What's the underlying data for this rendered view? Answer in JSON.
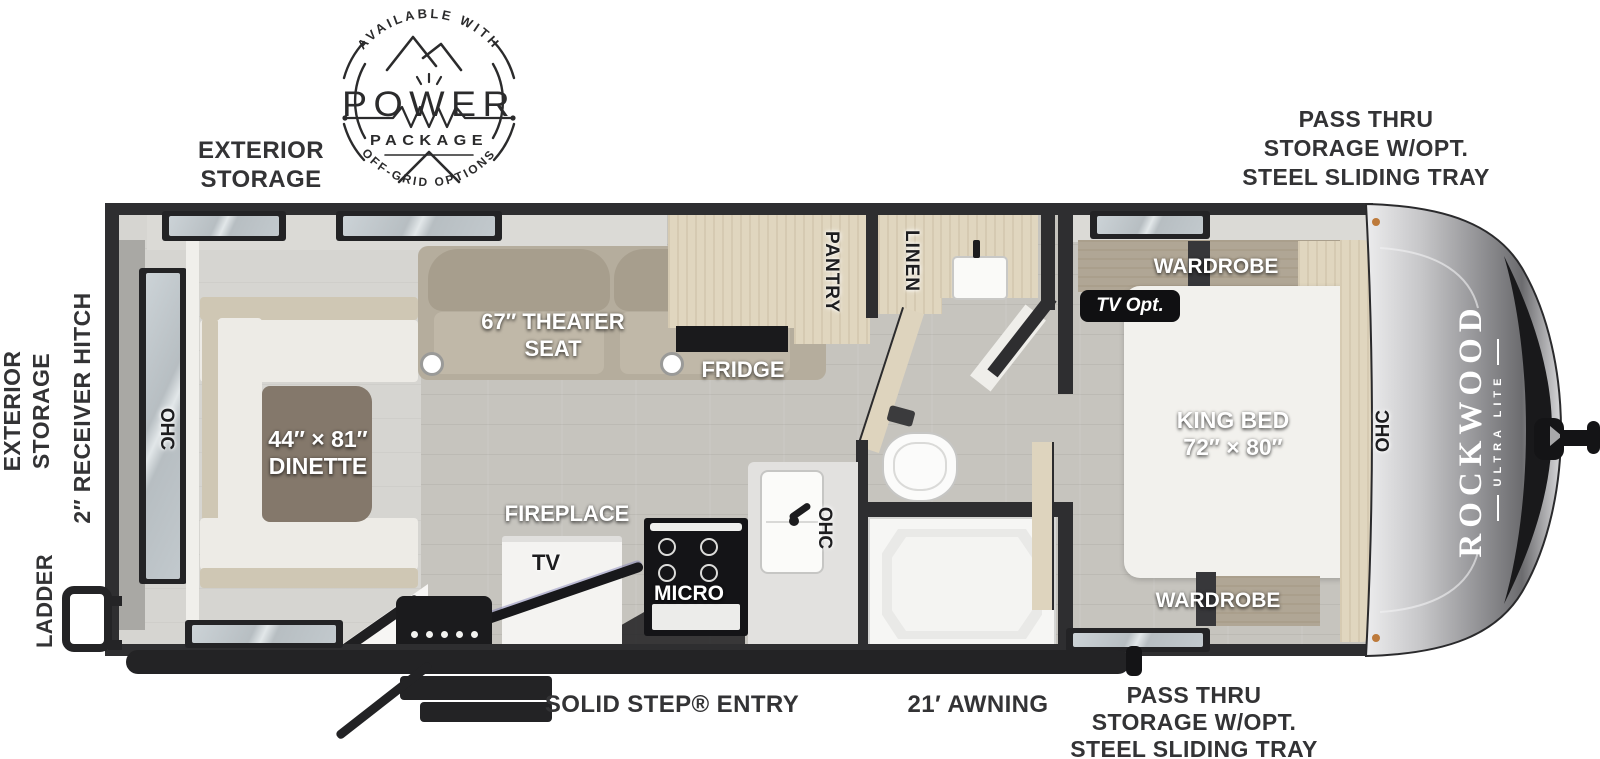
{
  "title": "Rockwood Ultra Lite travel trailer floorplan",
  "badge": {
    "arc_top": "AVAILABLE WITH",
    "word": "POWER",
    "word2": "PACKAGE",
    "arc_bottom": "OFF-GRID OPTIONS"
  },
  "exterior": {
    "storage_top": [
      "EXTERIOR",
      "STORAGE"
    ],
    "pass_thru_top": [
      "PASS THRU",
      "STORAGE W/OPT.",
      "STEEL SLIDING TRAY"
    ],
    "storage_left": [
      "EXTERIOR",
      "STORAGE"
    ],
    "receiver_hitch": "2″ RECEIVER HITCH",
    "ladder": "LADDER",
    "entry": "SOLID STEP® ENTRY",
    "awning": "21′ AWNING",
    "pass_thru_bottom": [
      "PASS THRU",
      "STORAGE W/OPT.",
      "STEEL SLIDING TRAY"
    ]
  },
  "interior": {
    "ohc_rear": "OHC",
    "ohc_kitchen": "OHC",
    "ohc_front": "OHC",
    "dinette": [
      "44″ × 81″",
      "DINETTE"
    ],
    "theater": [
      "67″ THEATER",
      "SEAT"
    ],
    "fridge": "FRIDGE",
    "pantry": "PANTRY",
    "linen": "LINEN",
    "fireplace": "FIREPLACE",
    "tv": "TV",
    "micro": "MICRO",
    "tv_opt": "TV Opt.",
    "wardrobe_top": "WARDROBE",
    "wardrobe_bottom": "WARDROBE",
    "king_bed": [
      "KING BED",
      "72″ × 80″"
    ]
  },
  "branding": {
    "name": "ROCKWOOD",
    "sub": "ULTRA LITE"
  },
  "colors": {
    "wall": "#2e2e30",
    "cabinet": "#e0d6bf",
    "floor": "#c6c4be",
    "label_dark": "#333335",
    "label_light": "#ffffff",
    "awning_bar": "#232325"
  }
}
